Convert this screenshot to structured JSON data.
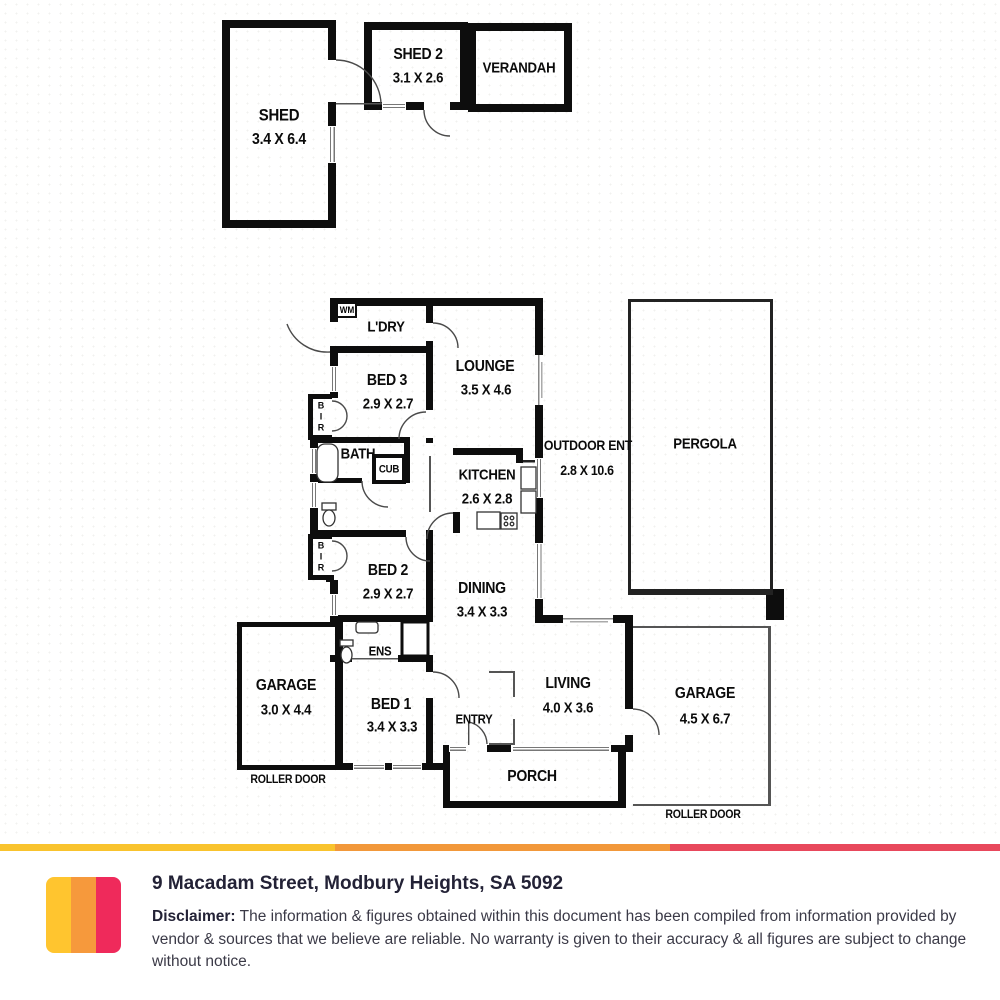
{
  "floorplan": {
    "rooms": {
      "shed": {
        "name": "SHED",
        "dims": "3.4 X 6.4"
      },
      "shed2": {
        "name": "SHED 2",
        "dims": "3.1 X 2.6"
      },
      "verandah": {
        "name": "VERANDAH"
      },
      "laundry": {
        "name": "L'DRY"
      },
      "bed3": {
        "name": "BED 3",
        "dims": "2.9 X 2.7"
      },
      "lounge": {
        "name": "LOUNGE",
        "dims": "3.5 X 4.6"
      },
      "bath": {
        "name": "BATH"
      },
      "cub": {
        "name": "CUB"
      },
      "kitchen": {
        "name": "KITCHEN",
        "dims": "2.6 X 2.8"
      },
      "outdoor_ent": {
        "name": "OUTDOOR ENT",
        "dims": "2.8 X 10.6"
      },
      "pergola": {
        "name": "PERGOLA"
      },
      "bed2": {
        "name": "BED 2",
        "dims": "2.9 X 2.7"
      },
      "dining": {
        "name": "DINING",
        "dims": "3.4 X 3.3"
      },
      "garage_left": {
        "name": "GARAGE",
        "dims": "3.0 X 4.4"
      },
      "ens": {
        "name": "ENS"
      },
      "bed1": {
        "name": "BED 1",
        "dims": "3.4 X 3.3"
      },
      "entry": {
        "name": "ENTRY"
      },
      "living": {
        "name": "LIVING",
        "dims": "4.0 X 3.6"
      },
      "garage_right": {
        "name": "GARAGE",
        "dims": "4.5 X 6.7"
      },
      "porch": {
        "name": "PORCH"
      }
    },
    "annotations": {
      "wm": "WM",
      "bir_letters": [
        "B",
        "I",
        "R"
      ],
      "roller_door_left": "ROLLER DOOR",
      "roller_door_right": "ROLLER DOOR"
    }
  },
  "footer": {
    "address": "9 Macadam Street, Modbury Heights, SA 5092",
    "disclaimer_label": "Disclaimer:",
    "disclaimer_text": " The information & figures obtained within this document has been compiled from information provided by vendor & sources that we believe are reliable. No warranty is given to their accuracy & all figures are subject to change without notice.",
    "brand_colors": {
      "bar_yellow": "#F9C32D",
      "bar_orange": "#F2983A",
      "bar_red": "#E8485C",
      "logo_yellow": "#FFC52F",
      "logo_orange": "#F6993C",
      "logo_red": "#EF2A5B"
    }
  }
}
